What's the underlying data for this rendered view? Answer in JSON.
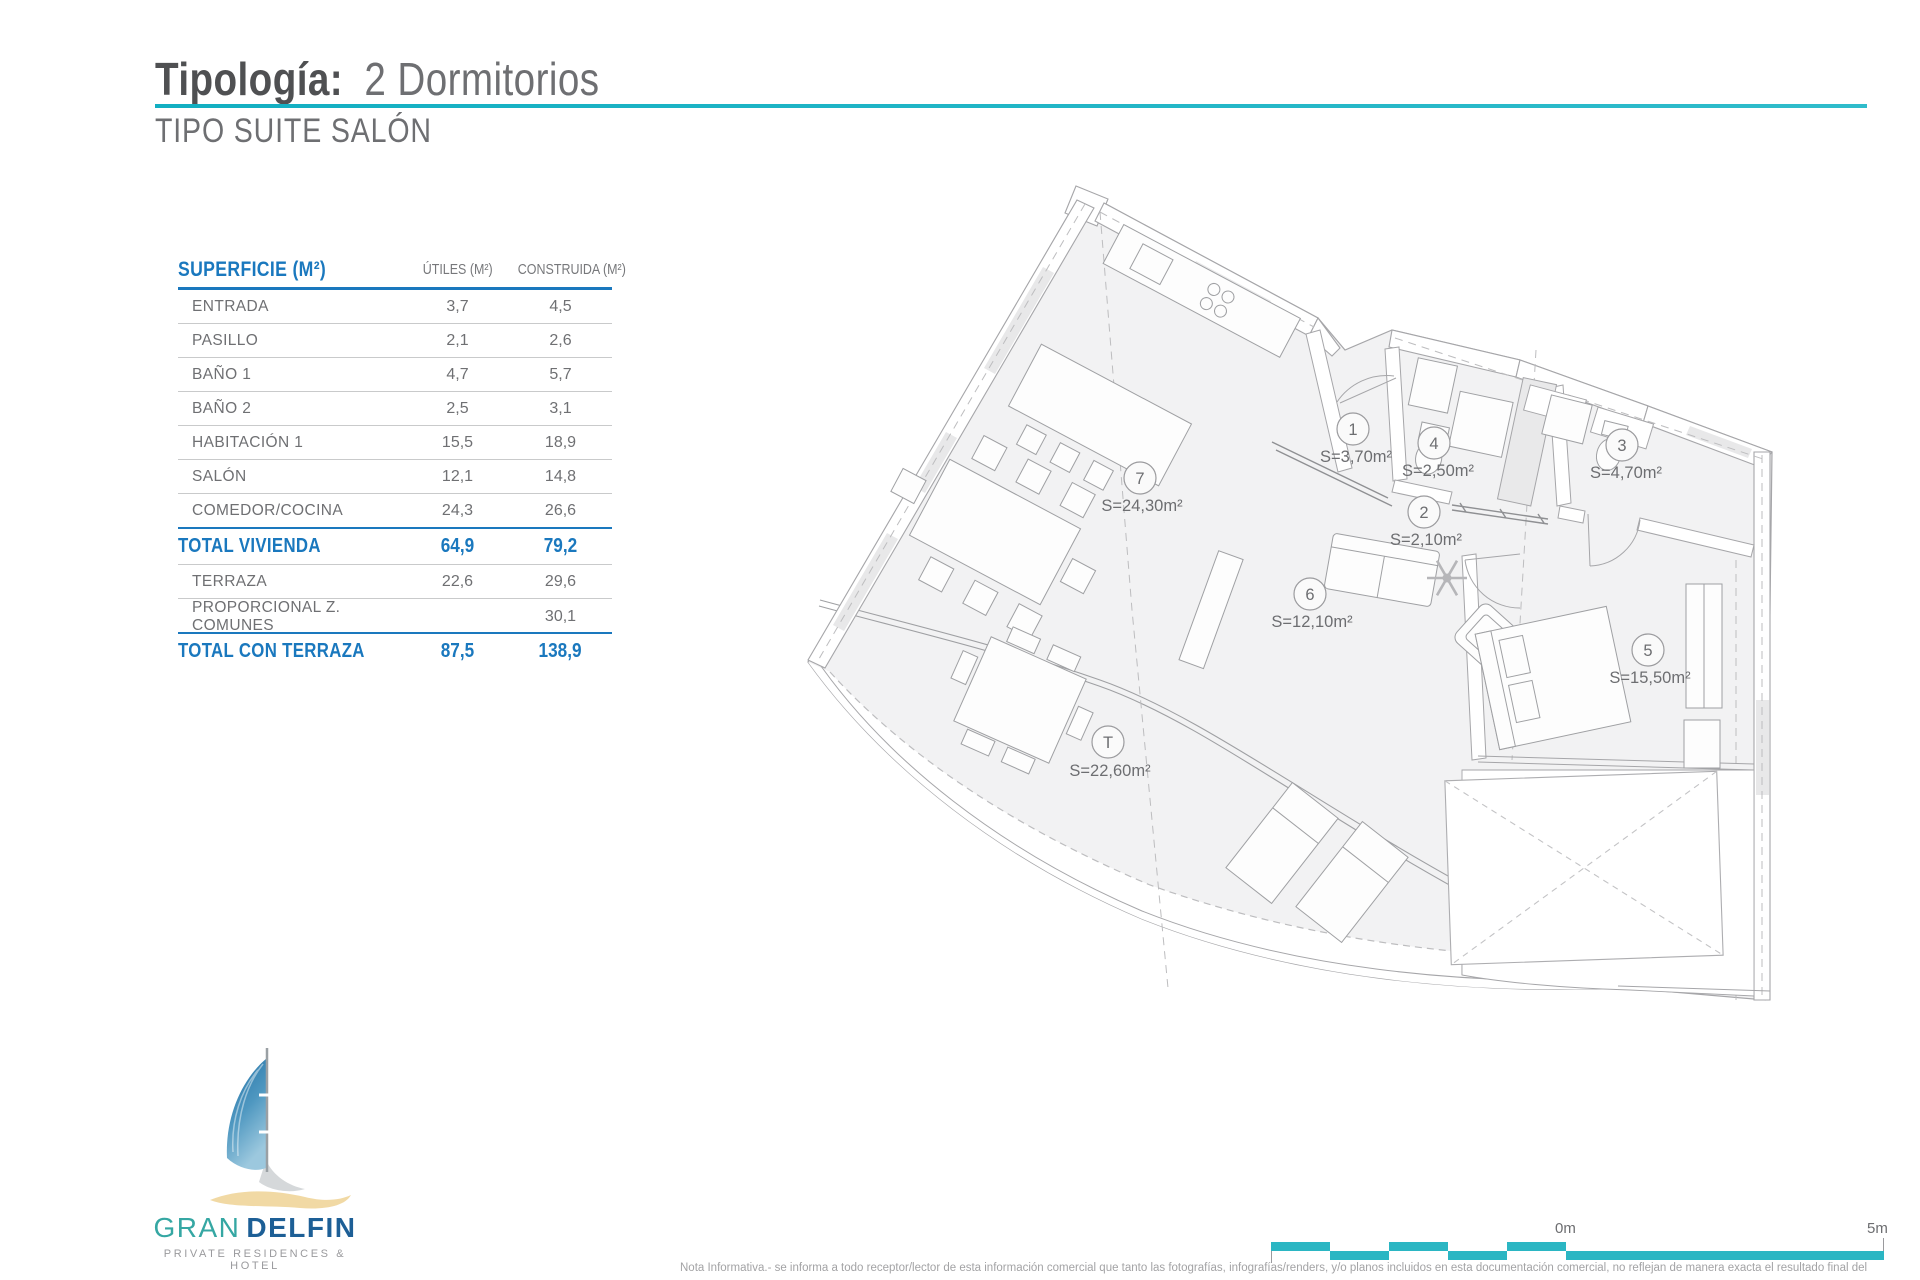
{
  "header": {
    "title_label": "Tipología:",
    "title_value": "2 Dormitorios",
    "subtitle": "TIPO SUITE SALÓN"
  },
  "table": {
    "col_label": "SUPERFICIE (M²)",
    "col_utiles": "ÚTILES (M²)",
    "col_construida": "CONSTRUIDA (M²)",
    "rows": [
      {
        "label": "ENTRADA",
        "utiles": "3,7",
        "construida": "4,5"
      },
      {
        "label": "PASILLO",
        "utiles": "2,1",
        "construida": "2,6"
      },
      {
        "label": "BAÑO 1",
        "utiles": "4,7",
        "construida": "5,7"
      },
      {
        "label": "BAÑO 2",
        "utiles": "2,5",
        "construida": "3,1"
      },
      {
        "label": "HABITACIÓN 1",
        "utiles": "15,5",
        "construida": "18,9"
      },
      {
        "label": "SALÓN",
        "utiles": "12,1",
        "construida": "14,8"
      },
      {
        "label": "COMEDOR/COCINA",
        "utiles": "24,3",
        "construida": "26,6"
      },
      {
        "label": "TOTAL VIVIENDA",
        "utiles": "64,9",
        "construida": "79,2"
      },
      {
        "label": "TERRAZA",
        "utiles": "22,6",
        "construida": "29,6"
      },
      {
        "label": "PROPORCIONAL Z. COMUNES",
        "utiles": "",
        "construida": "30,1"
      },
      {
        "label": "TOTAL CON TERRAZA",
        "utiles": "87,5",
        "construida": "138,9"
      }
    ]
  },
  "floorplan": {
    "rooms": [
      {
        "num": "7",
        "area": "S=24,30m²"
      },
      {
        "num": "1",
        "area": "S=3,70m²"
      },
      {
        "num": "4",
        "area": "S=2,50m²"
      },
      {
        "num": "3",
        "area": "S=4,70m²"
      },
      {
        "num": "2",
        "area": "S=2,10m²"
      },
      {
        "num": "6",
        "area": "S=12,10m²"
      },
      {
        "num": "5",
        "area": "S=15,50m²"
      },
      {
        "num": "T",
        "area": "S=22,60m²"
      }
    ]
  },
  "scalebar": {
    "start_label": "0m",
    "end_label": "5m"
  },
  "logo": {
    "brand_1": "GRAN",
    "brand_2": "DELFIN",
    "tagline": "PRIVATE RESIDENCES & HOTEL"
  },
  "footer": {
    "disclaimer": "Nota Informativa.- se informa a todo receptor/lector de esta información comercial que tanto las fotografías, infografías/renders, y/o planos incluidos en esta documentación comercial, no reflejan de manera exacta el resultado final del"
  },
  "colors": {
    "accent_teal": "#12afc2",
    "table_blue": "#1a78be",
    "scalebar_teal": "#2bb6c3",
    "logo_teal": "#35a7a3",
    "logo_navy": "#1d5f96",
    "sand": "#f1d9a4"
  }
}
